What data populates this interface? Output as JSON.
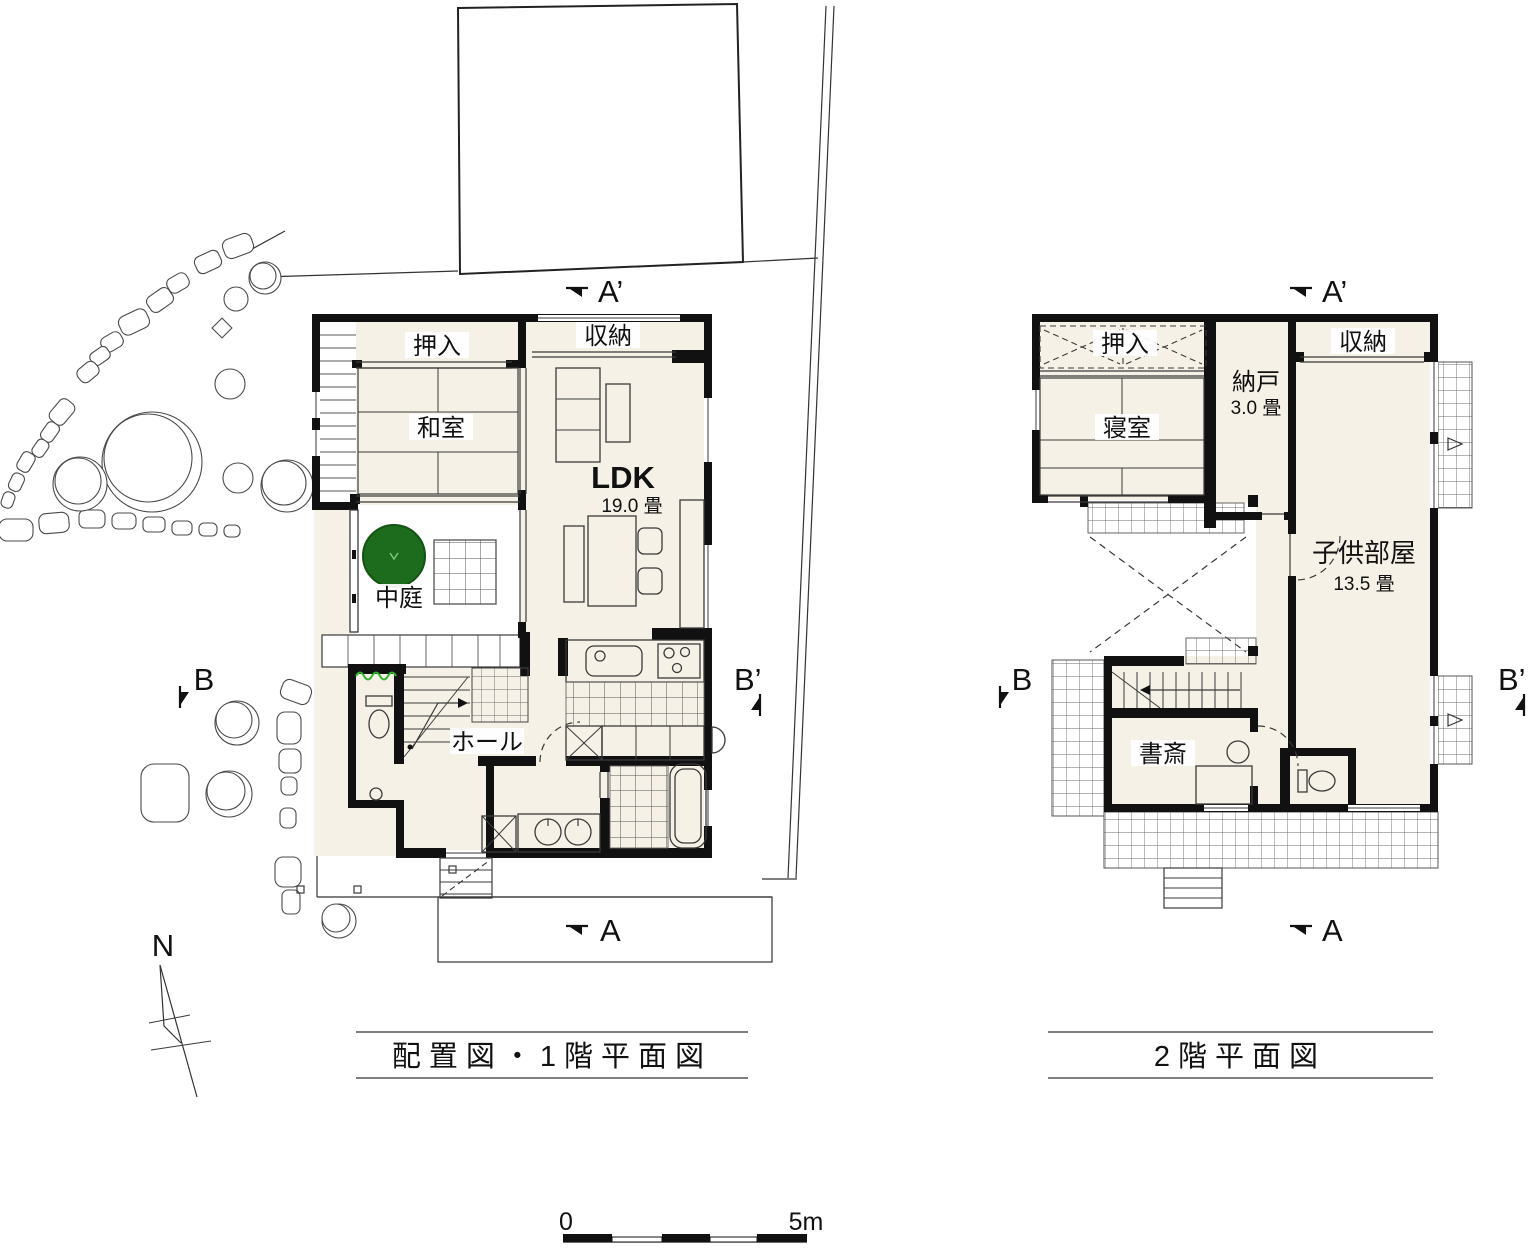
{
  "colors": {
    "wall": "#111111",
    "floor": "#f6f1e6",
    "line": "#3a3a3a",
    "tree": "#1d6b1d",
    "hedge": "#2db82d"
  },
  "sections": {
    "a_prime": "A’",
    "a": "A",
    "b": "B",
    "b_prime": "B’"
  },
  "plan1": {
    "title": "配置図・1階平面図",
    "labels": {
      "oshiire": "押入",
      "washitsu": "和室",
      "shuno": "収納",
      "ldk": "LDK",
      "ldk_size": "19.0 畳",
      "nakaniwa": "中庭",
      "hall": "ホール"
    }
  },
  "plan2": {
    "title": "2階平面図",
    "labels": {
      "oshiire": "押入",
      "shinshitsu": "寝室",
      "nando": "納戸",
      "nando_size": "3.0 畳",
      "shuno": "収納",
      "kodomobeya": "子供部屋",
      "kodomobeya_size": "13.5 畳",
      "shosai": "書斎"
    }
  },
  "compass": {
    "north": "N"
  },
  "scale": {
    "zero": "0",
    "five": "5m"
  }
}
